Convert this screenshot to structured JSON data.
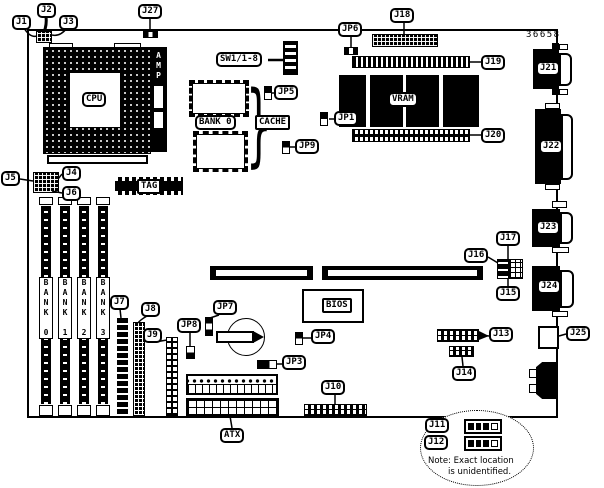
{
  "figure": {
    "part_number": "36658"
  },
  "callouts": {
    "j1": "J1",
    "j2": "J2",
    "j3": "J3",
    "j4": "J4",
    "j5": "J5",
    "j6": "J6",
    "j7": "J7",
    "j8": "J8",
    "j9": "J9",
    "j10": "J10",
    "j11": "J11",
    "j12": "J12",
    "j13": "J13",
    "j14": "J14",
    "j15": "J15",
    "j16": "J16",
    "j17": "J17",
    "j18": "J18",
    "j19": "J19",
    "j20": "J20",
    "j21": "J21",
    "j22": "J22",
    "j23": "J23",
    "j24": "J24",
    "j25": "J25",
    "j27": "J27",
    "jp1": "JP1",
    "jp3": "JP3",
    "jp4": "JP4",
    "jp5": "JP5",
    "jp6": "JP6",
    "jp7": "JP7",
    "jp8": "JP8",
    "jp9": "JP9",
    "sw1": "SW1/1-8",
    "atx": "ATX"
  },
  "chips": {
    "cpu": "CPU",
    "amp": "AMP",
    "vram": "VRAM",
    "cache": "CACHE",
    "cache_bank": "BANK 0",
    "tag": "TAG",
    "bios": "BIOS"
  },
  "memory_banks": [
    "BANK 0",
    "BANK 1",
    "BANK 2",
    "BANK 3"
  ],
  "note": {
    "line1": "Note: Exact location",
    "line2": "is unidentified."
  },
  "decorations": {
    "brace": "}"
  }
}
